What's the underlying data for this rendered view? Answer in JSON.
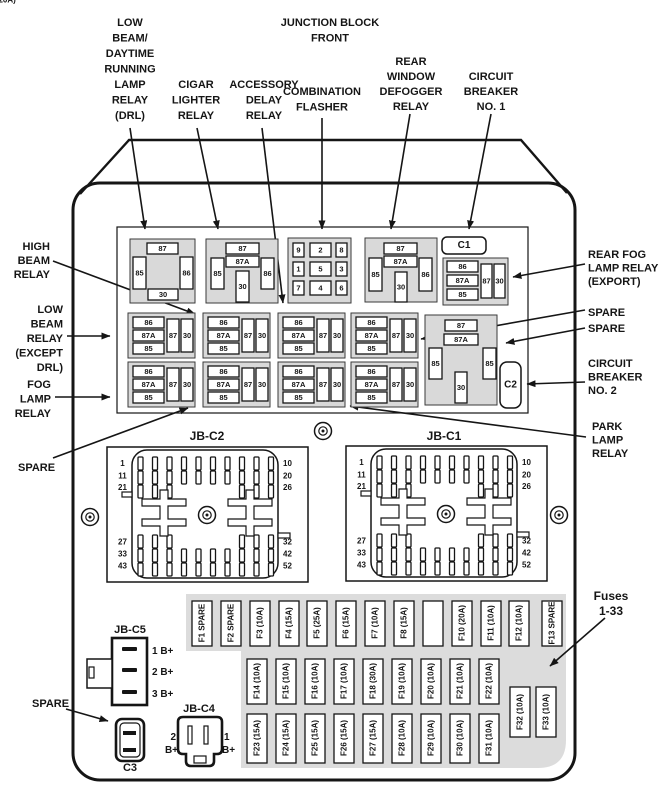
{
  "colors": {
    "block_fill": "#d9d9d9",
    "panel_fill": "#dcdcdc",
    "ink": "#151515"
  },
  "top_labels": {
    "drl": [
      "LOW",
      "BEAM/",
      "DAYTIME",
      "RUNNING",
      "LAMP",
      "RELAY",
      "(DRL)"
    ],
    "cigar": [
      "CIGAR",
      "LIGHTER",
      "RELAY"
    ],
    "accessory": [
      "ACCESSORY",
      "DELAY",
      "RELAY"
    ],
    "junction_block": [
      "JUNCTION BLOCK",
      "FRONT"
    ],
    "combination": [
      "COMBINATION",
      "FLASHER"
    ],
    "rear_defogger": [
      "REAR",
      "WINDOW",
      "DEFOGGER",
      "RELAY"
    ],
    "circuit_breaker_1": [
      "CIRCUIT",
      "BREAKER",
      "NO. 1"
    ]
  },
  "left_labels": {
    "high_beam": [
      "HIGH",
      "BEAM",
      "RELAY"
    ],
    "low_beam": [
      "LOW",
      "BEAM",
      "RELAY",
      "(EXCEPT",
      "DRL)"
    ],
    "fog_lamp": [
      "FOG",
      "LAMP",
      "RELAY"
    ],
    "spare": "SPARE",
    "spare_bottom": "SPARE"
  },
  "right_labels": {
    "rear_fog": [
      "REAR FOG",
      "LAMP RELAY",
      "(EXPORT)"
    ],
    "spare_1": "SPARE",
    "spare_2": "SPARE",
    "circuit_breaker_2": [
      "CIRCUIT",
      "BREAKER",
      "NO. 2"
    ],
    "park_lamp": [
      "PARK",
      "LAMP",
      "RELAY"
    ],
    "fuses_range": [
      "Fuses",
      "1-33"
    ]
  },
  "relays": {
    "pins": {
      "p30": "30",
      "p85": "85",
      "p86": "86",
      "p87": "87",
      "p87a": "87A"
    },
    "flasher": [
      [
        "9",
        "2",
        "8"
      ],
      [
        "1",
        "5",
        "3"
      ],
      [
        "7",
        "4",
        "6"
      ]
    ]
  },
  "connectors": {
    "c1": "C1",
    "c2": "C2",
    "c3": "C3",
    "jbc2": "JB-C2",
    "jbc1": "JB-C1",
    "jbc5": "JB-C5",
    "jbc4": "JB-C4",
    "jb_pins_left": [
      "1",
      "11",
      "21",
      "27",
      "33",
      "43"
    ],
    "jb_pins_right": [
      "10",
      "20",
      "26",
      "32",
      "42",
      "52"
    ],
    "jbc5_pins": [
      "1 B+",
      "2 B+",
      "3 B+"
    ],
    "jbc4_left_num": "2",
    "jbc4_left_bplus": "B+",
    "jbc4_right_num": "1",
    "jbc4_right_bplus": "B+"
  },
  "fuses": {
    "row1": [
      "F1 SPARE",
      "F2 SPARE",
      "F3 (10A)",
      "F4 (15A)",
      "F5 (25A)",
      "F6 (15A)",
      "F7 (10A)",
      "F8 (15A)",
      "F9 (20A)",
      "F10 (20A)",
      "F11 (10A)",
      "F12 (10A)",
      "F13 SPARE"
    ],
    "row2": [
      "F14 (10A)",
      "F15 (10A)",
      "F16 (10A)",
      "F17 (10A)",
      "F18 (30A)",
      "F19 (10A)",
      "F20 (10A)",
      "F21 (10A)",
      "F22 (10A)"
    ],
    "row3": [
      "F23 (15A)",
      "F24 (15A)",
      "F25 (15A)",
      "F26 (15A)",
      "F27 (15A)",
      "F28 (10A)",
      "F29 (10A)",
      "F30 (10A)",
      "F31 (10A)"
    ],
    "extra": [
      "F32 (10A)",
      "F33 (10A)"
    ]
  }
}
